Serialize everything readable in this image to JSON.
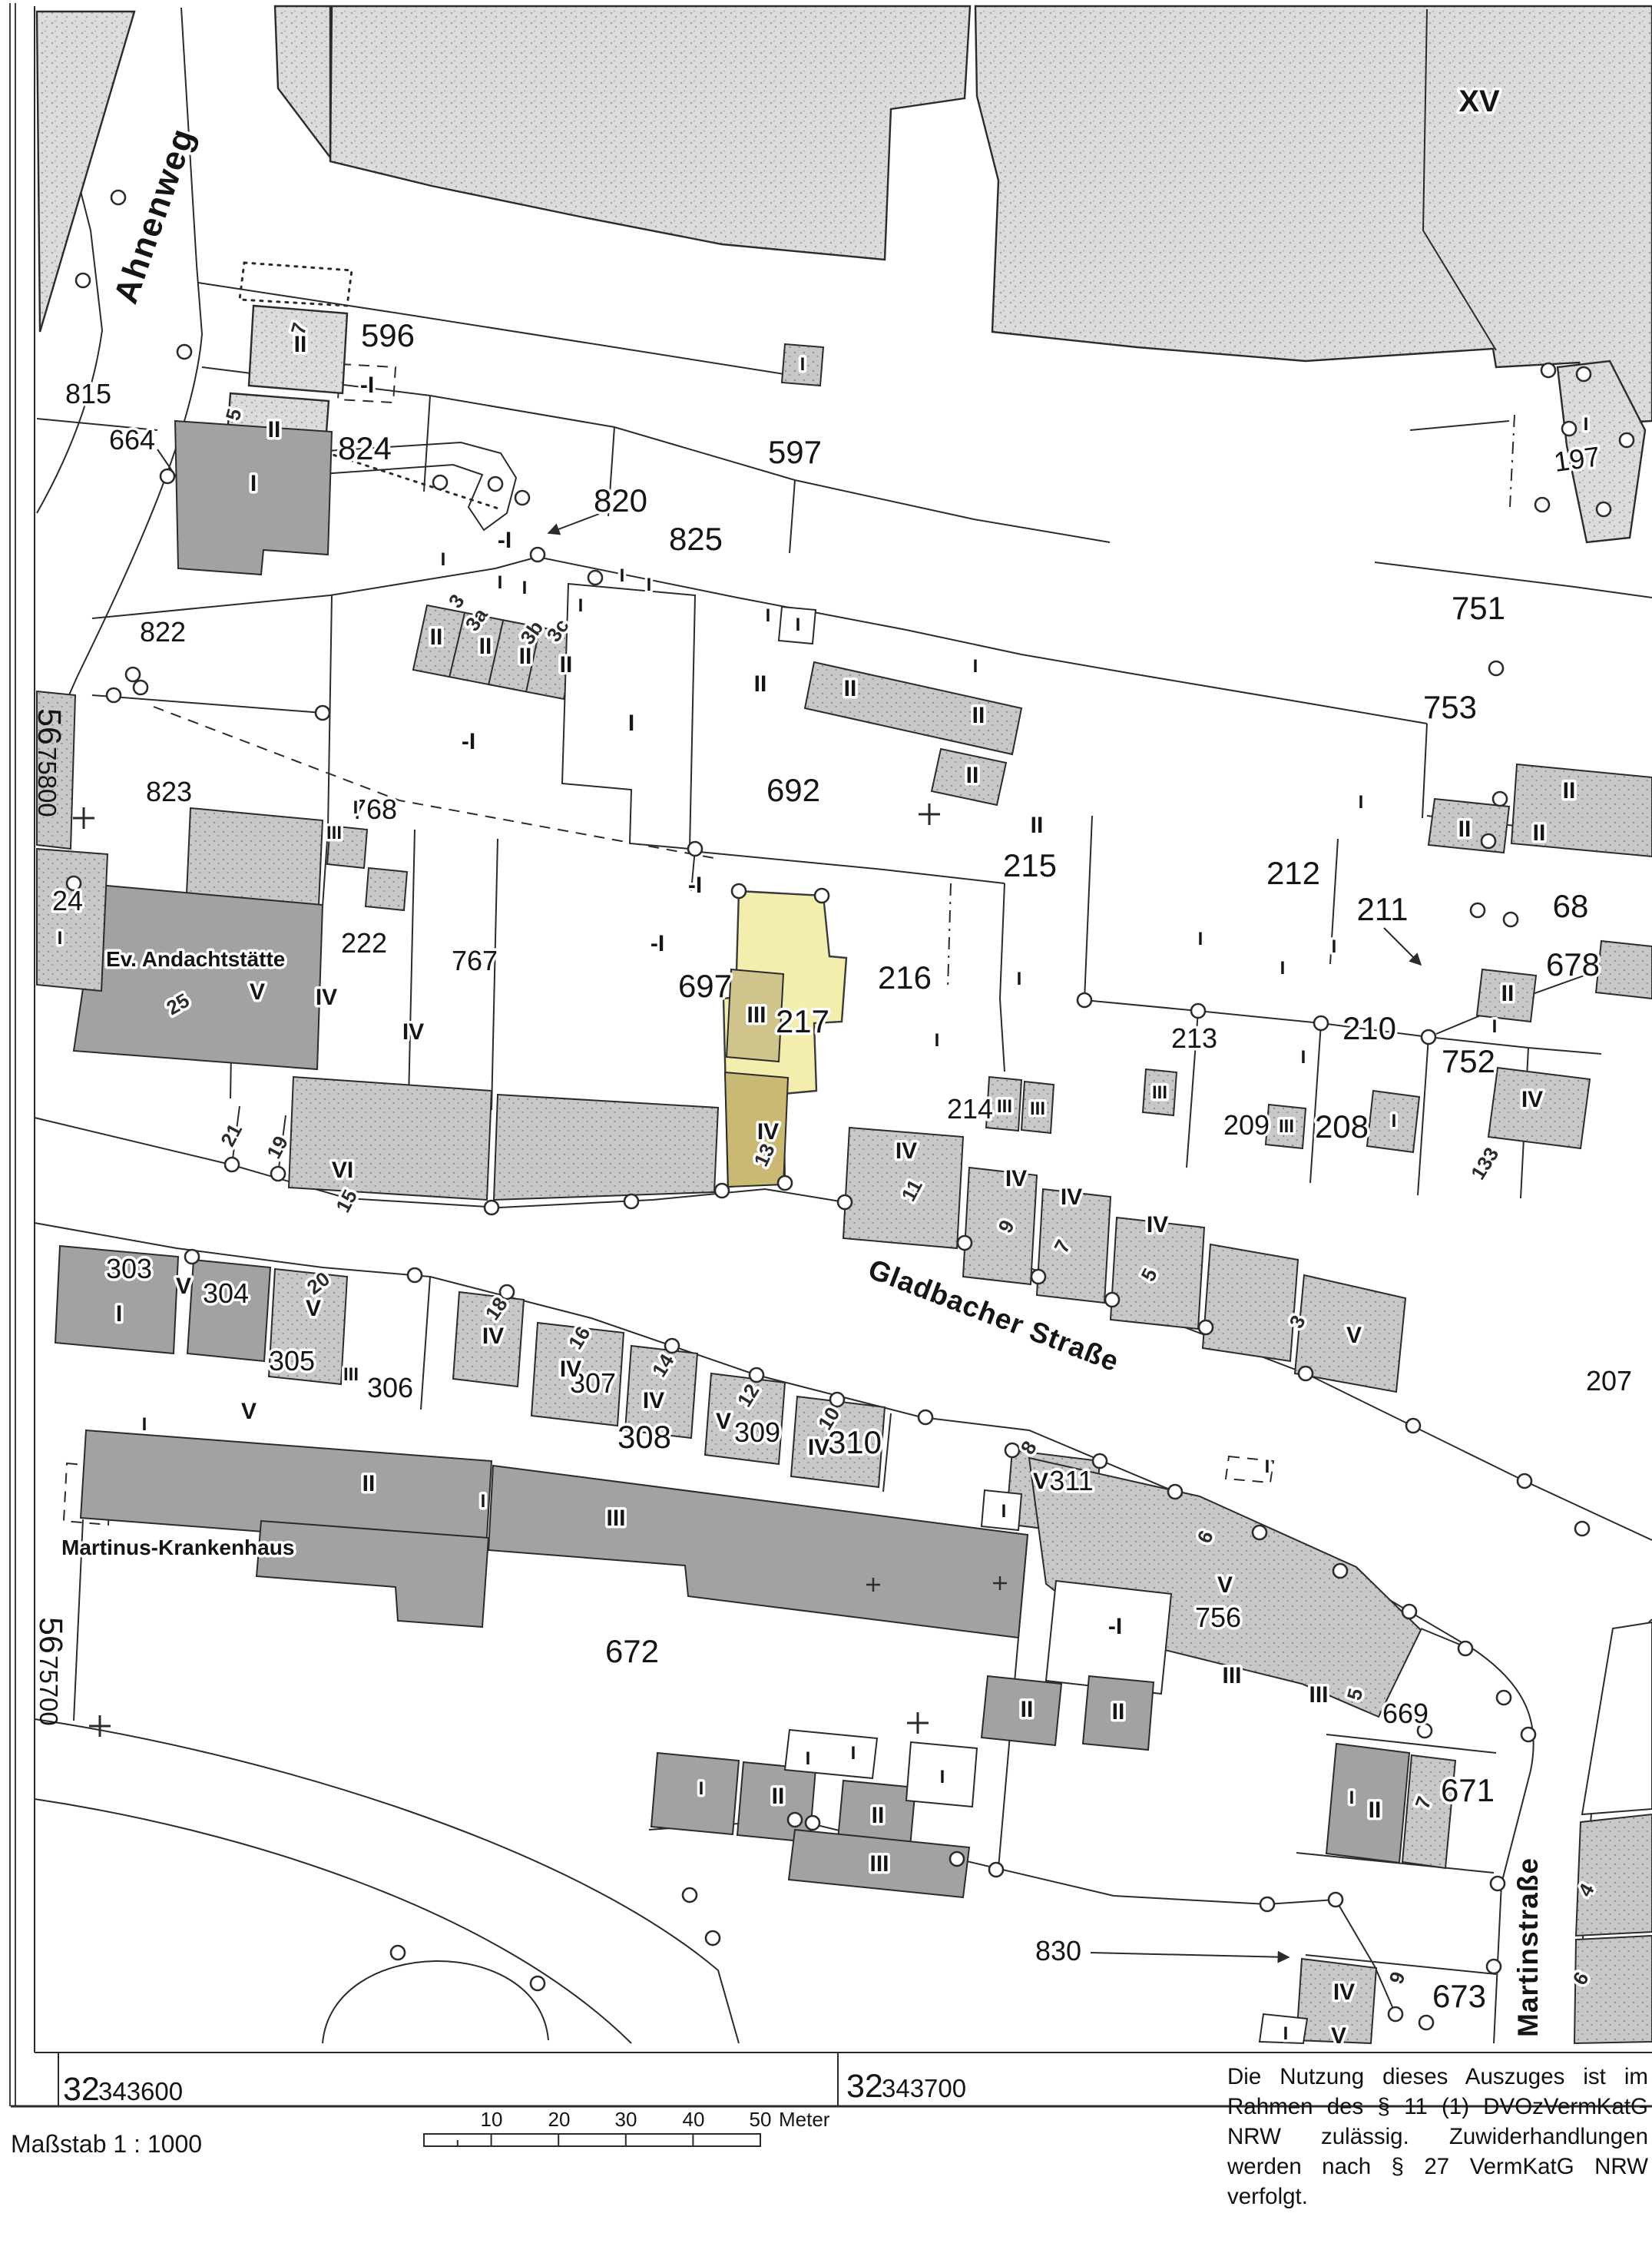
{
  "p": [
    "815",
    "664",
    "596",
    "824",
    "820",
    "825",
    "597",
    "822",
    "823",
    "768",
    "767",
    "222",
    "692",
    "697",
    "217",
    "216",
    "215",
    "212",
    "211",
    "213",
    "214",
    "210",
    "209",
    "208",
    "752",
    "751",
    "753",
    "197",
    "68",
    "678",
    "207",
    "303",
    "304",
    "305",
    "306",
    "307",
    "308",
    "309",
    "310",
    "311",
    "756",
    "672",
    "669",
    "671",
    "673",
    "830",
    "24"
  ],
  "s": [
    "II",
    "II",
    "-I",
    "-I",
    "I",
    "I",
    "I",
    "I",
    "I",
    "I",
    "II",
    "II",
    "II",
    "II",
    "I",
    "I",
    "II",
    "-I",
    "I",
    "I",
    "III",
    "I",
    "V",
    "IV",
    "IV",
    "VI",
    "-I",
    "-I",
    "III",
    "IV",
    "I",
    "II",
    "II",
    "II",
    "I",
    "I",
    "II",
    "I",
    "I",
    "II",
    "II",
    "II",
    "I",
    "I",
    "I",
    "I",
    "I",
    "I",
    "III",
    "III",
    "III",
    "III",
    "II",
    "I",
    "IV",
    "IV",
    "IV",
    "IV",
    "IV",
    "V",
    "V",
    "I",
    "V",
    "IV",
    "III",
    "V",
    "I",
    "IV",
    "IV",
    "V",
    "IV",
    "V",
    "I",
    "II",
    "III",
    "I",
    "V",
    "-I",
    "III",
    "III",
    "II",
    "III",
    "I",
    "II",
    "I",
    "I",
    "II",
    "I",
    "II",
    "II",
    "IV",
    "V",
    "I",
    "I",
    "I",
    "XV",
    "I"
  ],
  "h": [
    "7",
    "5",
    "3",
    "3a",
    "3b",
    "3c",
    "25",
    "21",
    "19",
    "15",
    "13",
    "11",
    "9",
    "7",
    "5",
    "3",
    "133",
    "20",
    "18",
    "16",
    "14",
    "12",
    "10",
    "8",
    "6",
    "5",
    "7",
    "9",
    "4",
    "6"
  ],
  "streets": [
    "Ahnenweg",
    "Gladbacher Straße",
    "Martinstraße"
  ],
  "pois": [
    "Ev. Andachtstätte",
    "Martinus-Krankenhaus"
  ],
  "margin": {
    "n1b": "56",
    "n1s": "75800",
    "n2b": "56",
    "n2s": "75700",
    "e1b": "32",
    "e1s": "343600",
    "e2b": "32",
    "e2s": "343700"
  },
  "legend": {
    "scale": "Maßstab 1 : 1000",
    "t1": "10",
    "t2": "20",
    "t3": "30",
    "t4": "40",
    "t5": "50",
    "unit": "Meter"
  },
  "legal": [
    "Die Nutzung dieses Auszuges ist im",
    "Rahmen des § 11 (1) DVOzVermKatG",
    "NRW zulässig. Zuwiderhandlungen",
    "werden nach § 27 VermKatG NRW",
    "verfolgt."
  ],
  "colors": {
    "highlight_parcel": "#f3eead",
    "highlight_building_upper": "#cfc48b",
    "highlight_building_lower": "#c9b973",
    "building_light": "#dcdcdc",
    "building_medium": "#c8c8c8",
    "building_dark": "#a2a2a2",
    "line": "#2b2b2b"
  }
}
